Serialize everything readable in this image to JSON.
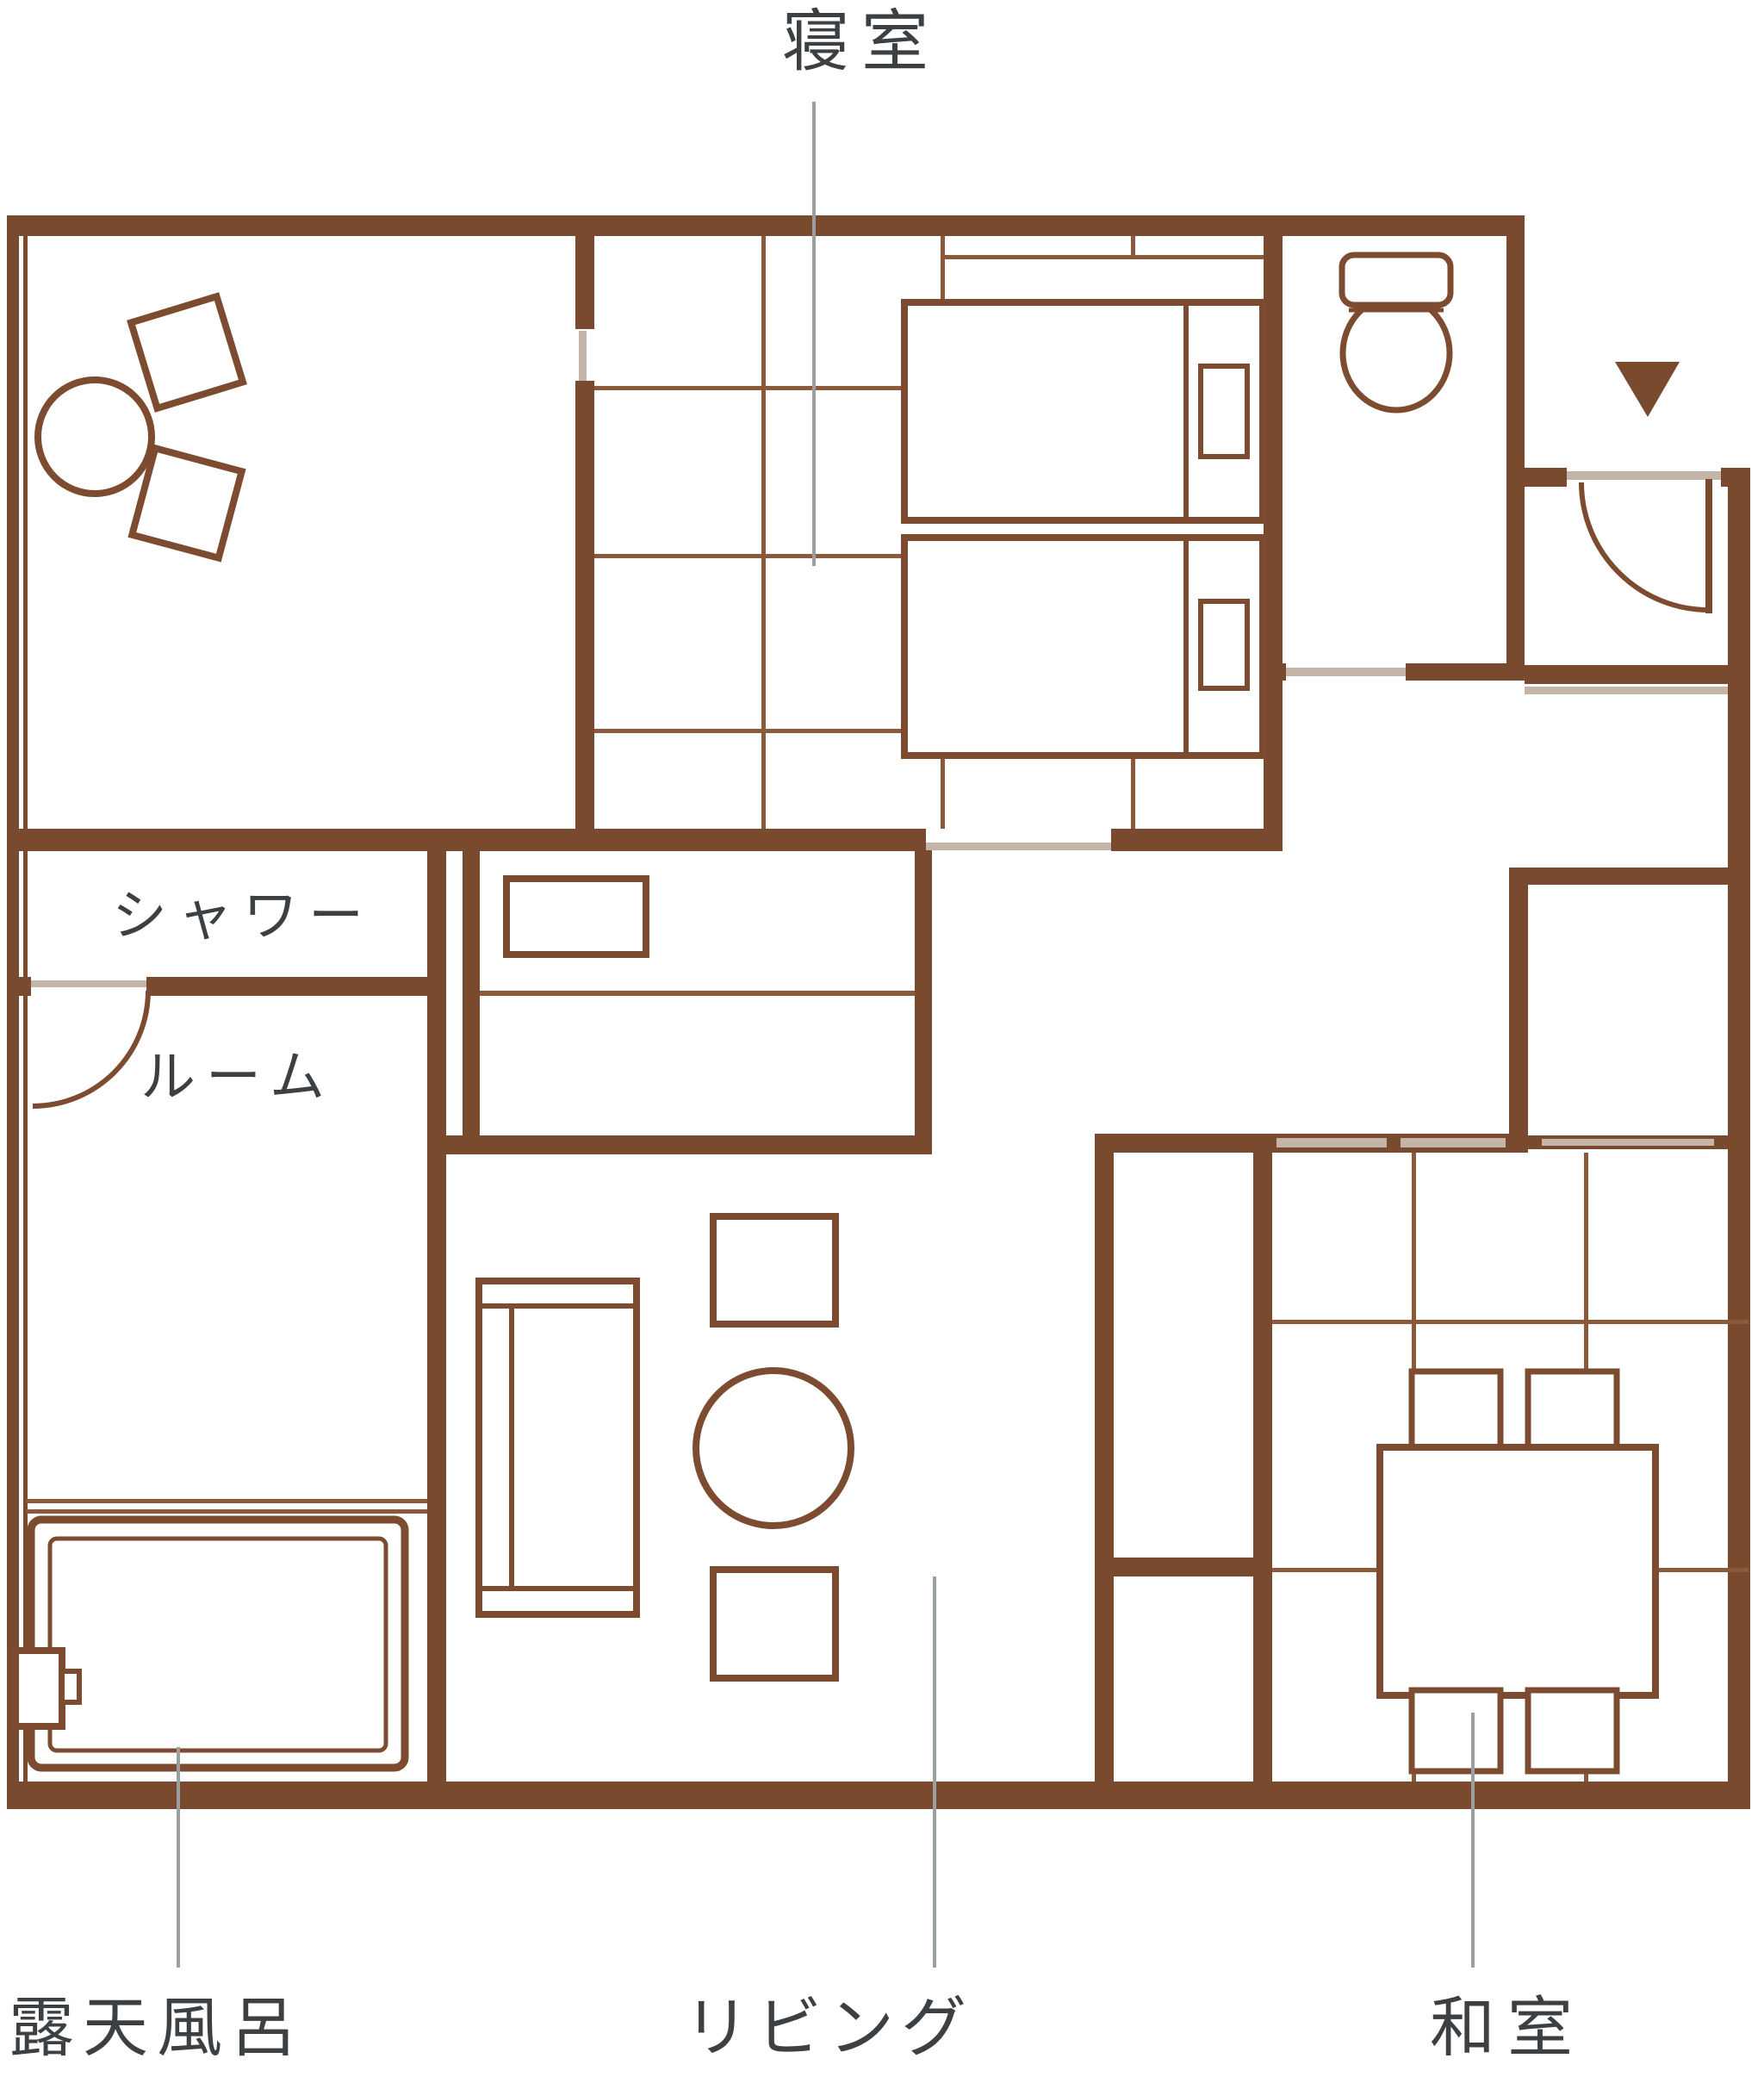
{
  "colors": {
    "bg": "#ffffff",
    "wall": "#7a4a2e",
    "tatami": "#8a5a3a",
    "furniture": "#7d4c30",
    "threshold": "#c3b5a7",
    "leader": "#9aa0a0",
    "text": "#3d4043"
  },
  "labels": {
    "bedroom": "寝室",
    "shower_line1": "シャワー",
    "shower_line2": "ルーム",
    "open_air_bath": "露天風呂",
    "living": "リビング",
    "japanese_room": "和室"
  }
}
